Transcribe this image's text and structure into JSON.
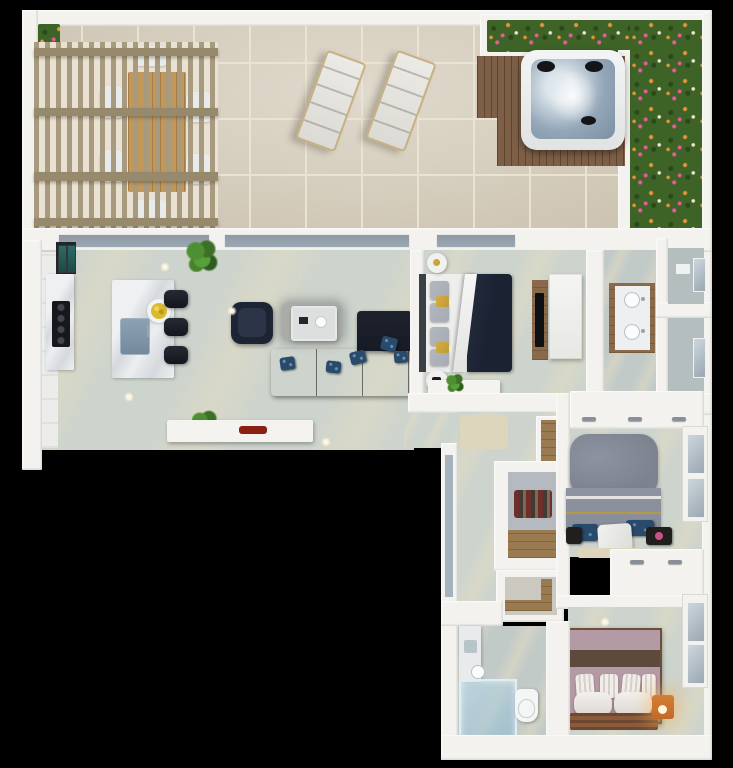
{
  "title": "3d-apartment-floor-plan-render",
  "colors": {
    "background": "#000000",
    "wall": "#f3f2ee",
    "terrace_tile": "#d8cfbe",
    "tile_grout": "#eae3d3",
    "hedge": "#3e6327",
    "hedge_dark": "#2b481a",
    "flower_pink": "#e85b9b",
    "flower_orange": "#e8963c",
    "flower_white": "#f2ead8",
    "pergola_wood": "#a79a7e",
    "beam_wood": "#97896c",
    "table_wood": "#c1985a",
    "deck_wood": "#7d5f47",
    "deck_line": "#5e452c",
    "water": "#93a7b8",
    "water_light": "#dde6ec",
    "headrest": "#141519",
    "floor": "#cdd4cd",
    "floor_dark": "#c2cac8",
    "floor_streak": "#e4dcc2",
    "marble_vein": "#d5d9dd",
    "cooktop": "#17181c",
    "teal_glass": "#2f6b66",
    "sink_blue": "#74899c",
    "fruit_yellow": "#d9ba2e",
    "stool_black": "#14161c",
    "chair_navy": "#1d2535",
    "sofa_navy": "#161b25",
    "pillow_blue": "#2a4a6b",
    "rug_gray": "#a9aca7",
    "console_white": "#f4f3f0",
    "red_decor": "#8a2112",
    "bed_sheet": "#ebecea",
    "bed_blanket": "#1b2232",
    "pillow_gray": "#a6abb3",
    "gold": "#c09a33",
    "headboard": "#3b4044",
    "tv_wood": "#8a6a4a",
    "tv_black": "#0e0f12",
    "window_glass": "#9aa8b3",
    "mat_beige": "#ddd5bc",
    "closet_wood": "#9a7a50",
    "clothes_red": "#6e2f2a",
    "bed2_pillow": "#7d828f",
    "bed2_duvet": "#868c98",
    "bed3_mauve": "#b49aa4",
    "bed3_brown": "#5e4a3c",
    "rug3_brown": "#8a5c3c",
    "nightstand_orange": "#c06a2a",
    "light_dot": "#fff6e0",
    "glass_blue": "#a3b2bd"
  },
  "scene": {
    "terrace": {
      "items": [
        "pergola",
        "outdoor-dining-table",
        "outdoor-chairs",
        "sun-lounger-left",
        "sun-lounger-right",
        "flower-hedge-left",
        "flower-planter-top",
        "flower-hedge-right",
        "wood-deck",
        "hot-tub",
        "tile-floor"
      ]
    },
    "living_room": {
      "items": [
        "tall-fridge-unit",
        "cooktop-counter",
        "kitchen-island",
        "island-sink",
        "fruit-bowl",
        "bar-stool",
        "bar-stool",
        "bar-stool",
        "potted-plant",
        "potted-plant",
        "armchair",
        "area-rug",
        "coffee-table",
        "sectional-sofa",
        "throw-pillows",
        "media-console",
        "red-decor-object",
        "sliding-glass-doors"
      ]
    },
    "bedroom_1": {
      "items": [
        "double-bed",
        "navy-blanket",
        "gold-cushions",
        "nightstand",
        "nightstand",
        "tv-wood-panel",
        "tv",
        "wardrobe-dresser",
        "low-console",
        "window"
      ]
    },
    "bathroom_1": {
      "items": [
        "double-sink-vanity",
        "wc-room",
        "shower-room",
        "window",
        "window"
      ]
    },
    "hallway": {
      "items": [
        "doormat",
        "shelf-closet",
        "walk-in-closet",
        "hanging-clothes",
        "bench-closet",
        "glass-side-panel"
      ]
    },
    "bedroom_2": {
      "items": [
        "double-bed",
        "gray-duvet",
        "patterned-pillows",
        "north-closet",
        "south-closet",
        "nightstand",
        "nightstand",
        "window"
      ]
    },
    "bedroom_3": {
      "items": [
        "double-bed",
        "striped-pillows",
        "striped-rug",
        "glowing-nightstand",
        "window",
        "ceiling-light"
      ]
    },
    "bathroom_2": {
      "items": [
        "vanity",
        "shower-head",
        "glass-shower",
        "toilet"
      ]
    }
  }
}
